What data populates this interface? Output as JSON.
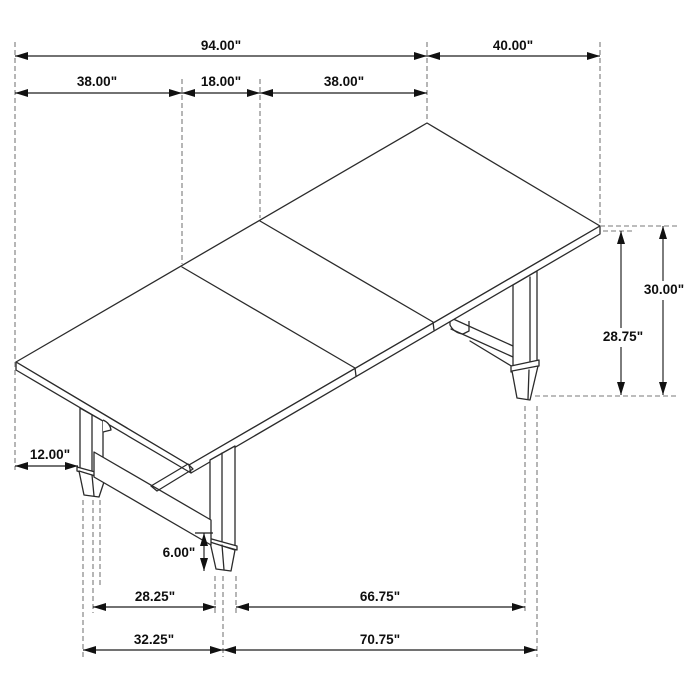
{
  "drawing": {
    "kind": "furniture-dimension-line-drawing",
    "subject": "rectangular trestle dining table with center extension leaf, isometric view",
    "unit": "inches",
    "dims": {
      "overall_length": "94.00\"",
      "end_width": "40.00\"",
      "section_left": "38.00\"",
      "leaf_width": "18.00\"",
      "section_right": "38.00\"",
      "height_top": "30.00\"",
      "height_underside": "28.75\"",
      "leg_inset_side": "12.00\"",
      "foot_height": "6.00\"",
      "front_leg_gap_inner": "28.25\"",
      "long_leg_gap_inner": "66.75\"",
      "front_leg_gap_outer": "32.25\"",
      "long_leg_gap_outer": "70.75\""
    }
  }
}
